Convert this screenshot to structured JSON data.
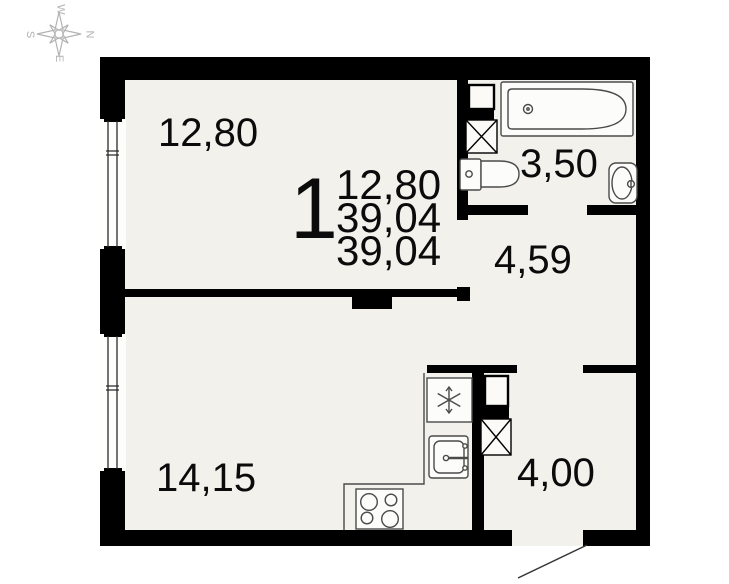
{
  "compass": {
    "north": "N",
    "south": "S",
    "east": "E",
    "west": "W"
  },
  "apartment": {
    "number": "1",
    "stats": {
      "living_area": "12,80",
      "total_area": "39,04",
      "total_area_with_balcony": "39,04"
    }
  },
  "rooms": {
    "living": "12,80",
    "bathroom": "3,50",
    "hallway": "4,59",
    "kitchen_living": "14,15",
    "entrance_hall": "4,00"
  },
  "colors": {
    "wall": "#000000",
    "floor": "#f3f1ec",
    "fixture": "#4a4a4a",
    "compass": "#b3b3b3"
  }
}
